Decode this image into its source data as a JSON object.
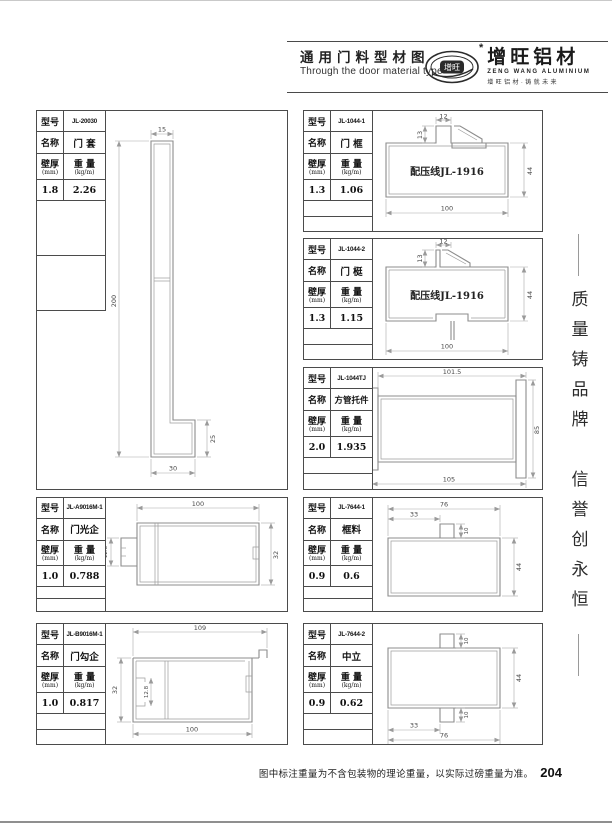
{
  "header": {
    "title": "通用门料型材图",
    "subtitle": "Through the door material type",
    "logo": {
      "oval_text": "增旺",
      "star": "*",
      "brand": "增旺铝材",
      "brand_en": "ZENG WANG ALUMINIUM",
      "tagline": "增旺铝材·铸就未来"
    }
  },
  "labels": {
    "model": "型号",
    "name": "名称",
    "thickness": "壁厚",
    "thickness_unit": "(mm)",
    "weight": "重 量",
    "weight_unit": "(kg/m)"
  },
  "slogan": {
    "line1": "质量铸品牌",
    "line2": "信誉创永恒"
  },
  "footer": {
    "note": "图中标注重量为不含包装物的理论重量，以实际过磅重量为准。",
    "page": "204"
  },
  "panels": [
    {
      "model": "JL-20030",
      "name": "门 套",
      "thickness": "1.8",
      "weight": "2.26",
      "dims": [
        "15",
        "200",
        "25",
        "30"
      ]
    },
    {
      "model": "JL-1044-1",
      "name": "门 框",
      "thickness": "1.3",
      "weight": "1.06",
      "note": "配压线JL-1916",
      "dims": [
        "12",
        "13",
        "100",
        "44"
      ]
    },
    {
      "model": "JL-1044-2",
      "name": "门 梃",
      "thickness": "1.3",
      "weight": "1.15",
      "note": "配压线JL-1916",
      "dims": [
        "12",
        "13",
        "100",
        "44"
      ]
    },
    {
      "model": "JL-1044TJ",
      "name": "方管托件",
      "thickness": "2.0",
      "weight": "1.935",
      "dims": [
        "101.5",
        "85",
        "105"
      ]
    },
    {
      "model": "JL-A9016M-1",
      "name": "门光企",
      "thickness": "1.0",
      "weight": "0.788",
      "dims": [
        "100",
        "12.8",
        "32"
      ]
    },
    {
      "model": "JL-B9016M-1",
      "name": "门勾企",
      "thickness": "1.0",
      "weight": "0.817",
      "dims": [
        "109",
        "32",
        "12.8",
        "100"
      ]
    },
    {
      "model": "JL-7644-1",
      "name": "框料",
      "thickness": "0.9",
      "weight": "0.6",
      "dims": [
        "76",
        "33",
        "10",
        "44"
      ]
    },
    {
      "model": "JL-7644-2",
      "name": "中立",
      "thickness": "0.9",
      "weight": "0.62",
      "dims": [
        "10",
        "44",
        "10",
        "33",
        "76"
      ]
    }
  ]
}
